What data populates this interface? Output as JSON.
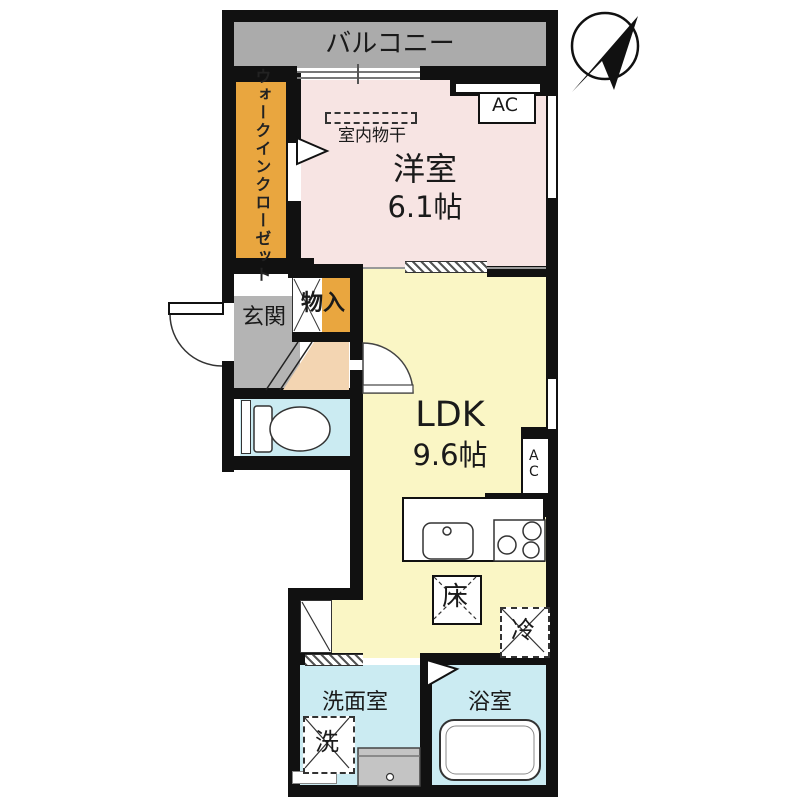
{
  "plan": {
    "balcony_label": "バルコニー",
    "western_room_label": "洋室",
    "western_room_size": "6.1帖",
    "wic_line1": "ウォークイン",
    "wic_line2": "クローゼット",
    "indoor_drying_label": "室内物干",
    "ac_label": "AC",
    "ac_ldk_label": "AC",
    "storage_label": "物入",
    "genkan_label": "玄関",
    "ldk_label": "LDK",
    "ldk_size": "9.6帖",
    "floor_storage_label": "床",
    "refrigerator_label": "冷",
    "washroom_label": "洗面室",
    "washer_label": "洗",
    "bathroom_label": "浴室"
  },
  "colors": {
    "balcony": "#ababab",
    "wic": "#e9a63f",
    "western_room": "#f7e4e3",
    "ldk": "#faf6c5",
    "wet_rooms": "#cbebf2",
    "genkan": "#b4b4b4",
    "hall": "#f3d5b2",
    "storage_accent": "#e9a63f",
    "wall": "#111111"
  }
}
